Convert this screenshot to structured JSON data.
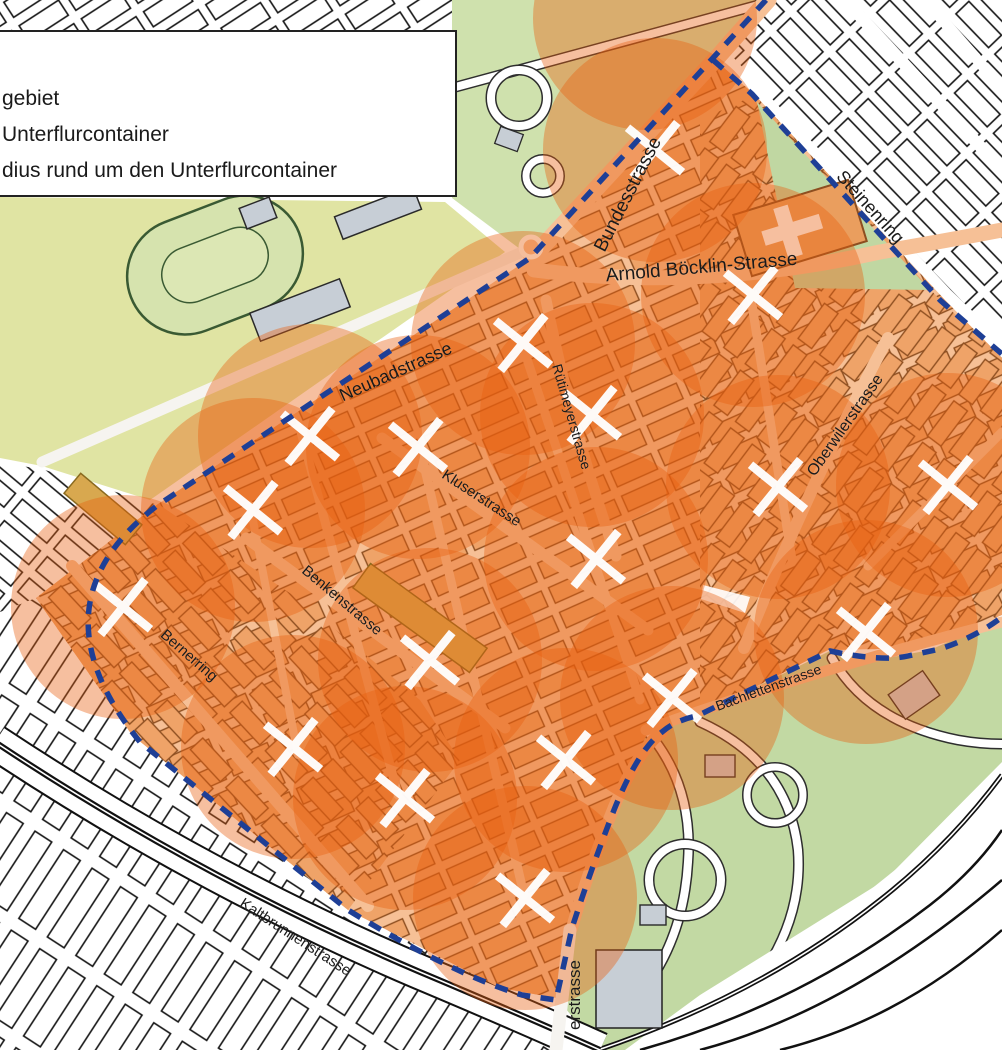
{
  "legend": {
    "items": [
      {
        "label": "gebiet"
      },
      {
        "label": "Unterflurcontainer"
      },
      {
        "label": "dius rund um den Unterflurcontainer"
      }
    ]
  },
  "map": {
    "colors": {
      "radius_fill": "rgba(232,96,16,0.40)",
      "border_blue": "#1e3f96",
      "marker": "#ffffff",
      "district_base": "#f6c096",
      "district_building": "#efa368",
      "building_outline": "#8d4e20",
      "field_yellow": "#e0e4a3",
      "park_green": "#c2d9a3",
      "top_park_green": "#cfe1ad",
      "gray_building": "#c7ced5"
    },
    "radius_px": 112,
    "extra_radius_centers": [
      {
        "x": 645,
        "y": 18
      }
    ],
    "containers": [
      {
        "x": 655,
        "y": 150
      },
      {
        "x": 753,
        "y": 295
      },
      {
        "x": 523,
        "y": 343
      },
      {
        "x": 592,
        "y": 415
      },
      {
        "x": 310,
        "y": 436
      },
      {
        "x": 418,
        "y": 447
      },
      {
        "x": 948,
        "y": 485
      },
      {
        "x": 778,
        "y": 487
      },
      {
        "x": 253,
        "y": 510
      },
      {
        "x": 596,
        "y": 559
      },
      {
        "x": 123,
        "y": 607
      },
      {
        "x": 866,
        "y": 632
      },
      {
        "x": 430,
        "y": 660
      },
      {
        "x": 672,
        "y": 698
      },
      {
        "x": 293,
        "y": 747
      },
      {
        "x": 566,
        "y": 760
      },
      {
        "x": 405,
        "y": 798
      },
      {
        "x": 525,
        "y": 898
      }
    ],
    "street_labels": [
      {
        "name": "Bundesstrasse",
        "x": 633,
        "y": 197,
        "rot": -63,
        "size": 19
      },
      {
        "name": "Steinenring",
        "x": 866,
        "y": 211,
        "rot": 48,
        "size": 18
      },
      {
        "name": "Arnold Böcklin-Strasse",
        "x": 702,
        "y": 273,
        "rot": -5,
        "size": 19
      },
      {
        "name": "Neubadstrasse",
        "x": 398,
        "y": 377,
        "rot": -24,
        "size": 18
      },
      {
        "name": "Rütimeyerstrasse",
        "x": 567,
        "y": 418,
        "rot": 74,
        "size": 14
      },
      {
        "name": "Kluserstrasse",
        "x": 479,
        "y": 502,
        "rot": 33,
        "size": 15
      },
      {
        "name": "Oberwilerstrasse",
        "x": 849,
        "y": 428,
        "rot": -55,
        "size": 16
      },
      {
        "name": "Benkenstrasse",
        "x": 339,
        "y": 604,
        "rot": 40,
        "size": 15
      },
      {
        "name": "Bernerring",
        "x": 186,
        "y": 659,
        "rot": 41,
        "size": 15
      },
      {
        "name": "Bachlettenstrasse",
        "x": 770,
        "y": 692,
        "rot": -20,
        "size": 14
      },
      {
        "name": "Kaltbrunnenstrasse",
        "x": 293,
        "y": 941,
        "rot": 33,
        "size": 15
      },
      {
        "name": "erstrasse",
        "x": 580,
        "y": 995,
        "rot": -90,
        "size": 17
      }
    ]
  }
}
